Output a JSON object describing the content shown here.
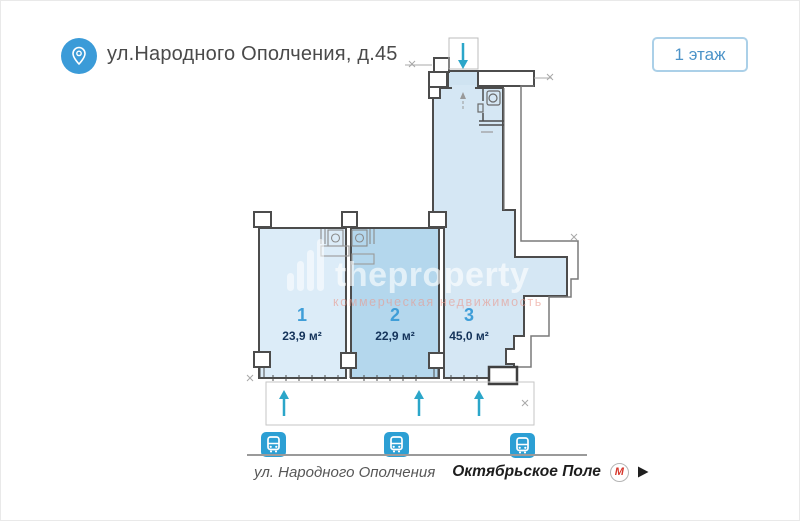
{
  "header": {
    "address": "ул.Народного Ополчения, д.45",
    "floor_badge": "1 этаж"
  },
  "watermark": {
    "brand": "theproperty",
    "subtitle": "коммерческая недвижимость"
  },
  "plan": {
    "rooms": [
      {
        "number": "1",
        "area": "23,9 м²"
      },
      {
        "number": "2",
        "area": "22,9 м²"
      },
      {
        "number": "3",
        "area": "45,0 м²"
      }
    ]
  },
  "footer": {
    "street": "ул. Народного Ополчения",
    "metro_station": "Октябрьское Поле",
    "metro_letter": "М"
  },
  "colors": {
    "accent_blue": "#3b9bd8",
    "badge_border": "#abd0e8",
    "badge_text": "#4c93c8",
    "room_fill_light": "#dcecf8",
    "room_fill_selected": "#b4d7ed",
    "wing_fill": "#d5e7f4",
    "wall": "#4c4c4c",
    "arrow_teal": "#2ba6c9",
    "bus_icon_blue": "#2c9fd4",
    "metro_red": "#d6362b"
  }
}
